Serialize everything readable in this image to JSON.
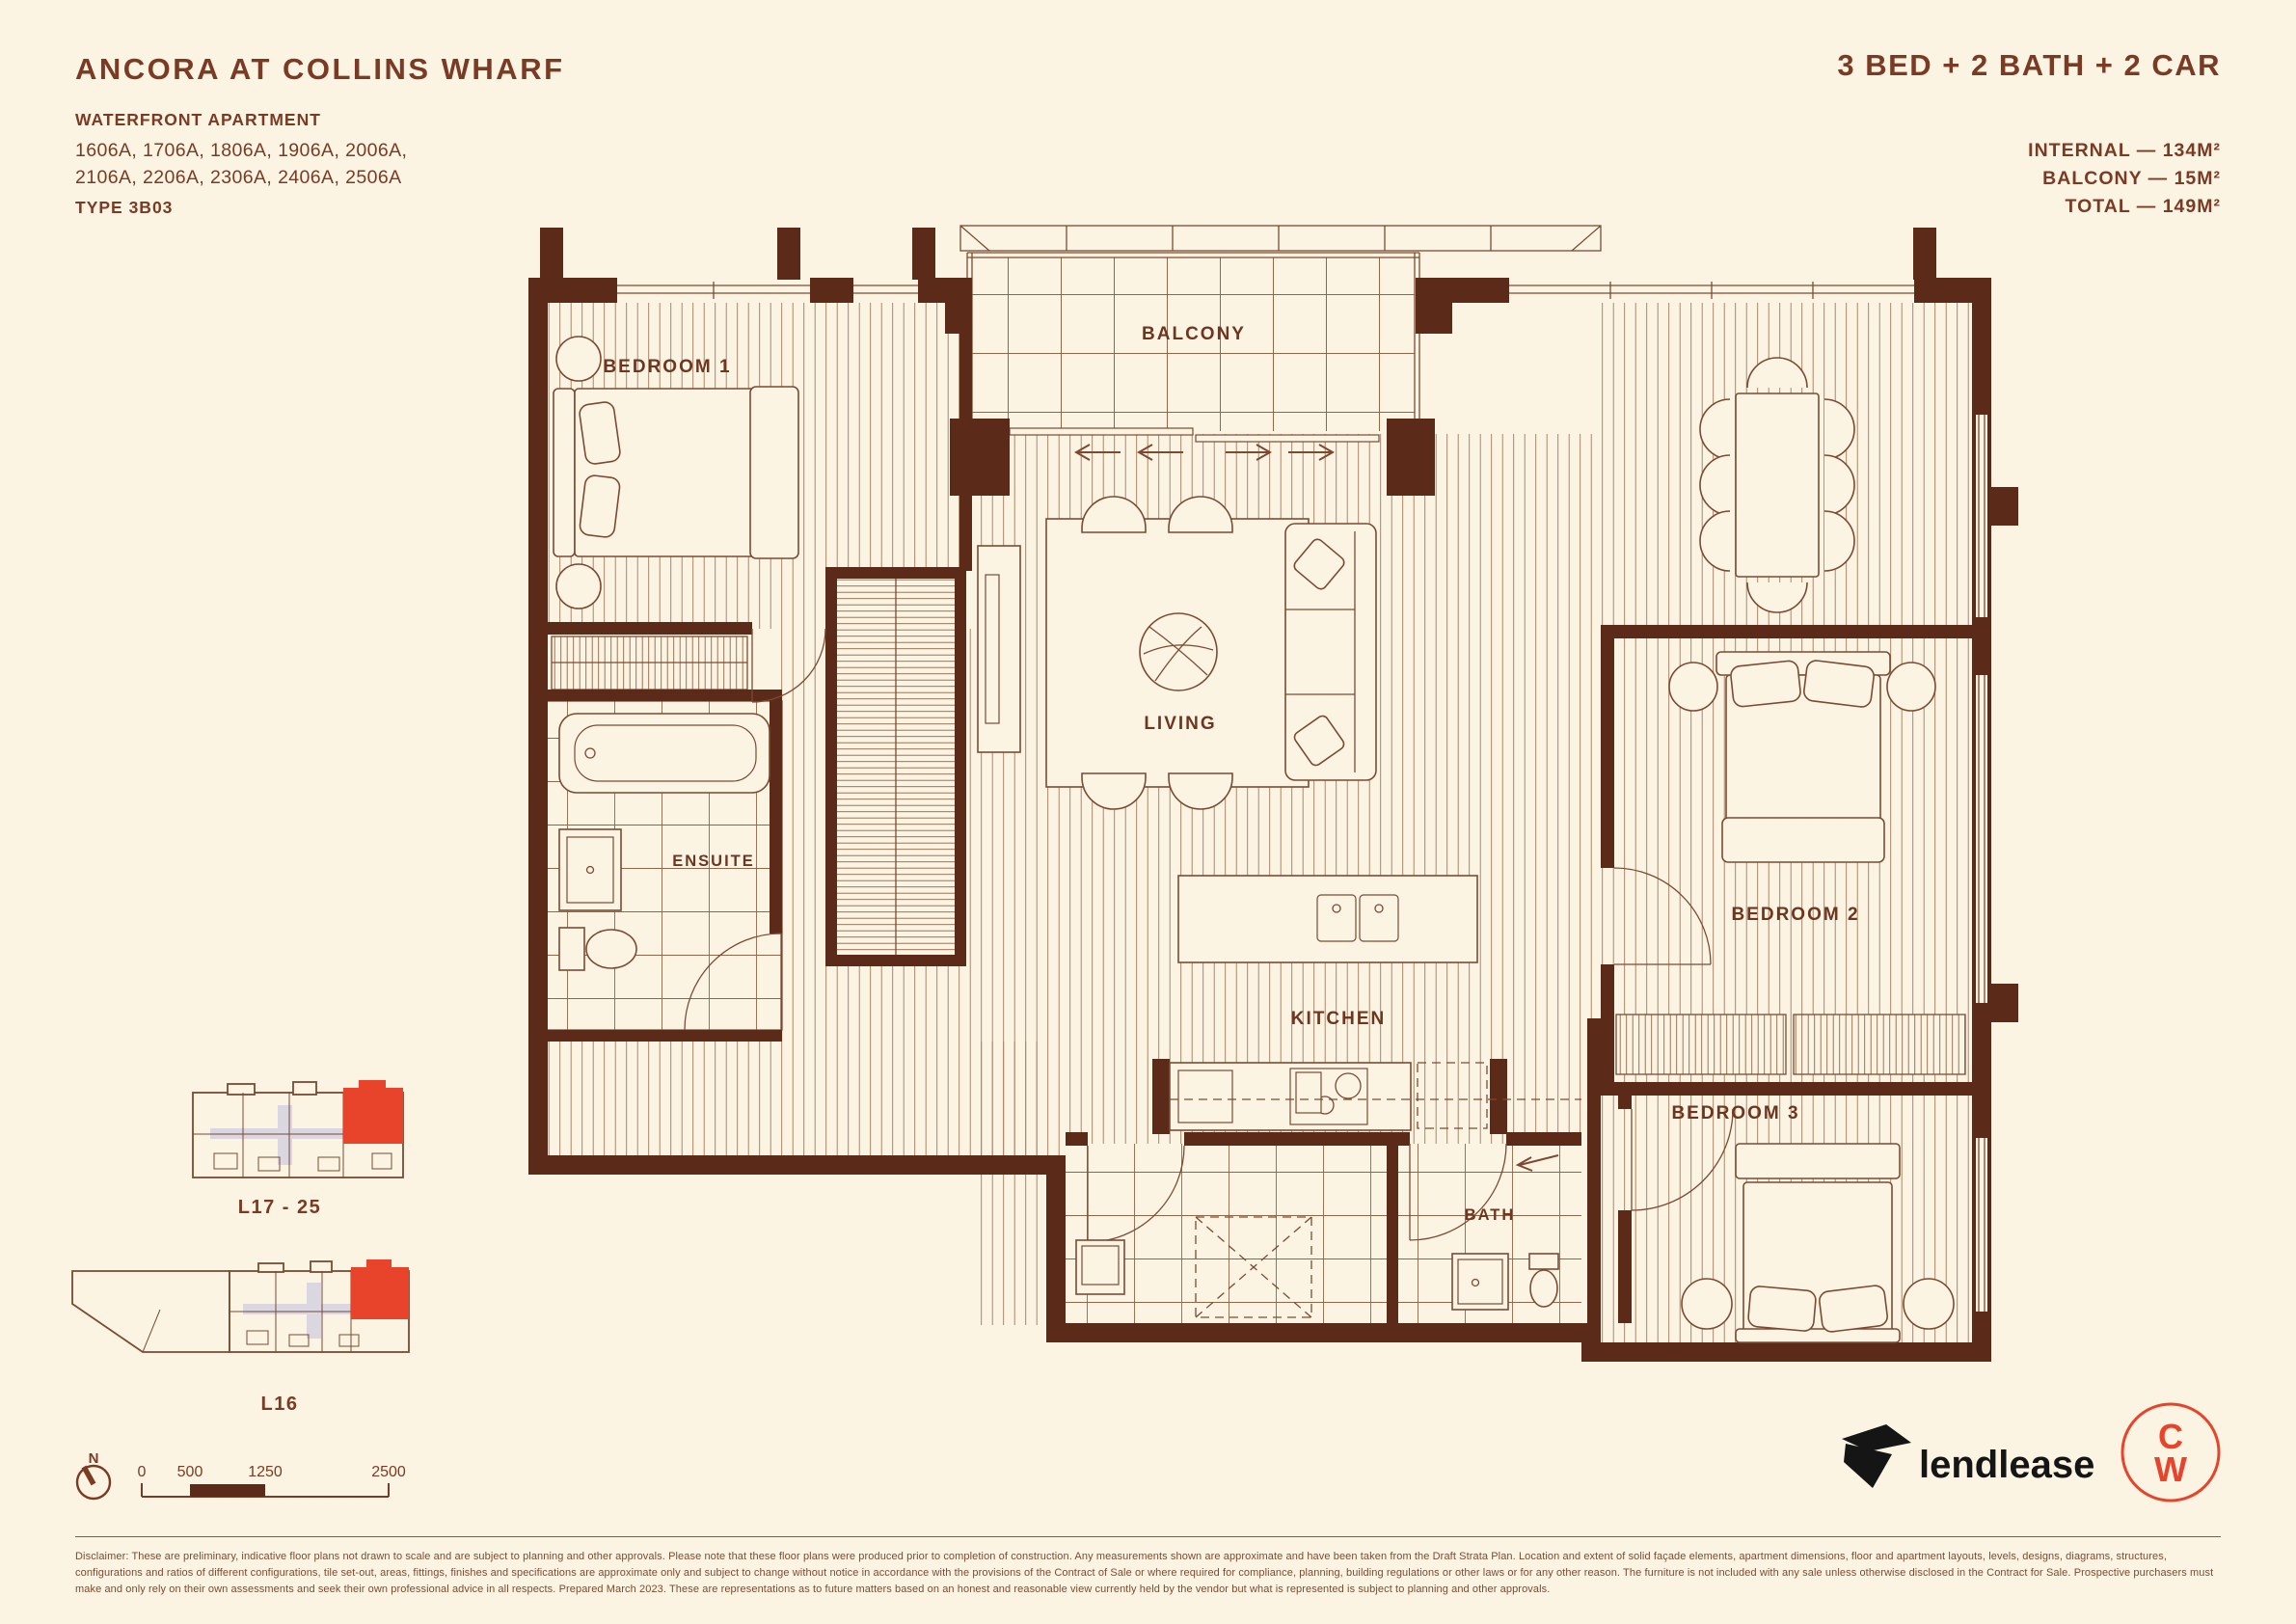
{
  "colors": {
    "background": "#FBF4E3",
    "ink": "#7A3A23",
    "wall": "#5C2A18",
    "line": "#7C4A33",
    "highlight_red": "#E8432B",
    "logo_black": "#151515",
    "keyplan_gray": "#DBD7E0"
  },
  "header": {
    "title": "ANCORA AT COLLINS WHARF",
    "subtitle": "WATERFRONT APARTMENT",
    "units_line1": "1606A, 1706A, 1806A, 1906A, 2006A,",
    "units_line2": "2106A, 2206A, 2306A, 2406A, 2506A",
    "type": "TYPE 3B03",
    "config": "3 BED + 2 BATH + 2 CAR",
    "areas": [
      {
        "text": "INTERNAL — 134M²"
      },
      {
        "text": "BALCONY — 15M²"
      },
      {
        "text": "TOTAL — 149M²"
      }
    ]
  },
  "plan": {
    "rooms": [
      {
        "label": "BEDROOM 1"
      },
      {
        "label": "BALCONY"
      },
      {
        "label": "LIVING"
      },
      {
        "label": "ENSUITE"
      },
      {
        "label": "KITCHEN"
      },
      {
        "label": "BEDROOM 2"
      },
      {
        "label": "BEDROOM 3"
      },
      {
        "label": "BATH"
      }
    ]
  },
  "keyplans": {
    "plan1_label": "L17 - 25",
    "plan2_label": "L16"
  },
  "scalebar": {
    "labels": [
      "0",
      "500",
      "1250",
      "2500"
    ]
  },
  "compass": {
    "label": "N"
  },
  "logos": {
    "lendlease": "lendlease",
    "cw_top": "C",
    "cw_bottom": "W"
  },
  "disclaimer": {
    "text": "Disclaimer: These are preliminary, indicative floor plans not drawn to scale and are subject to planning and other approvals. Please note that these floor plans were produced prior to completion of construction. Any measurements shown are approximate and have been taken from the Draft Strata Plan. Location and extent of solid façade elements, apartment dimensions, floor and apartment layouts, levels, designs, diagrams, structures, configurations and ratios of different configurations, tile set-out, areas, fittings, finishes and specifications are approximate only and subject to change without notice in accordance with the provisions of the Contract of Sale or where required for compliance, planning, building regulations or other laws or for any other reason. The furniture is not included with any sale unless otherwise disclosed in the Contract for Sale. Prospective purchasers must make and only rely on their own assessments and seek their own professional advice in all respects. Prepared March 2023. These are representations as to future matters based on an honest and reasonable view currently held by the vendor but what is represented is subject to planning and other approvals."
  }
}
